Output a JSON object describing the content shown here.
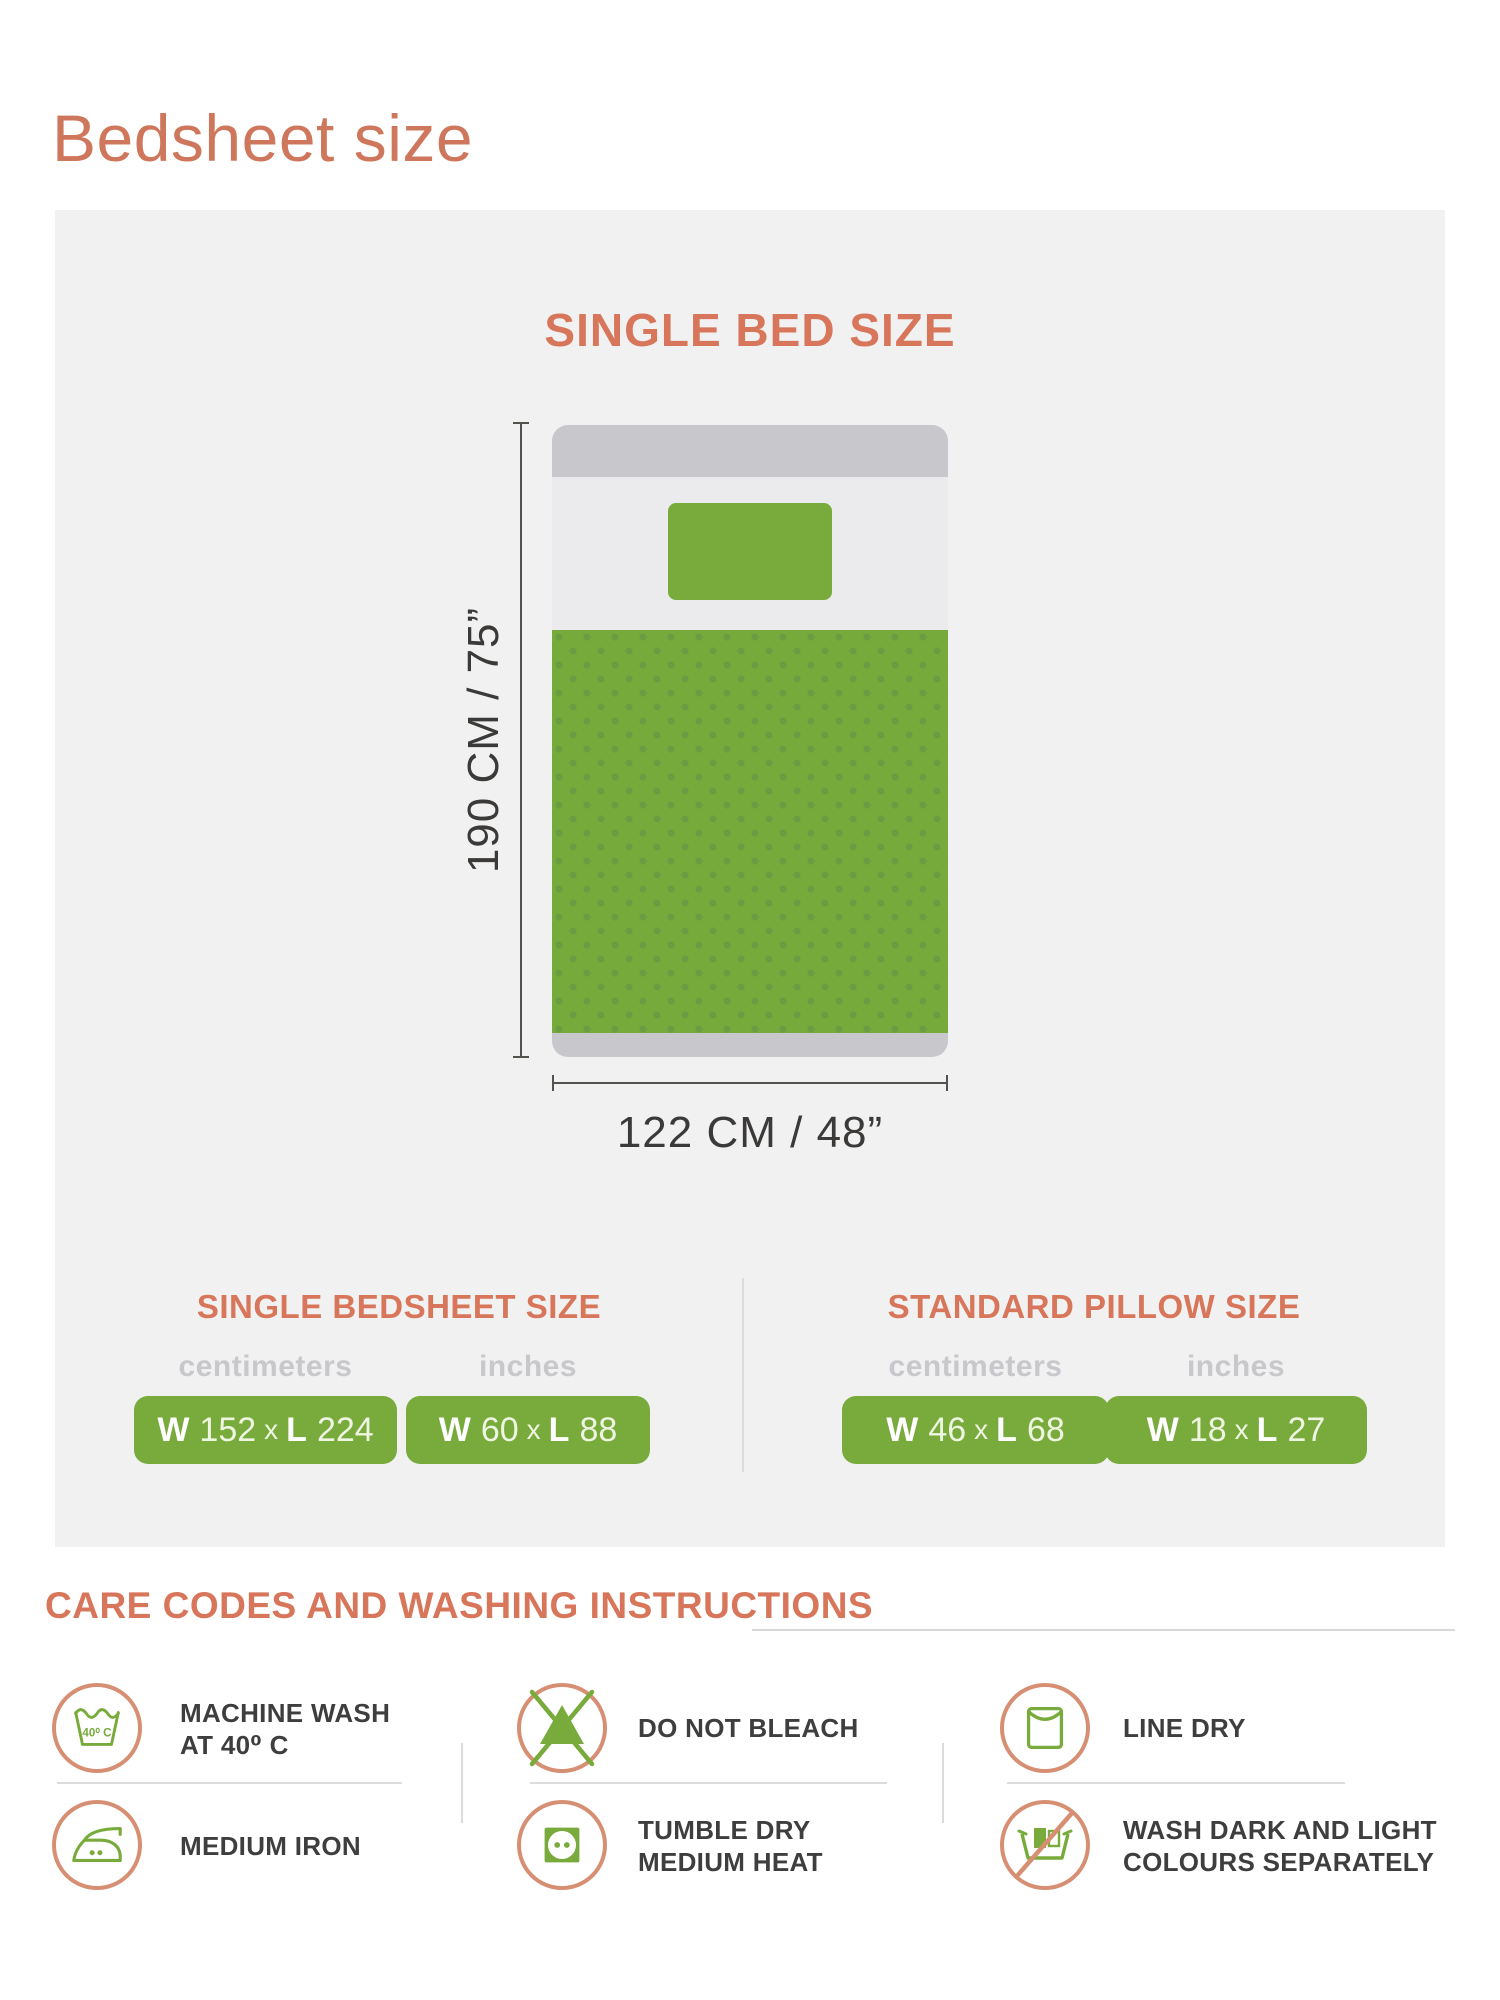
{
  "page_title": "Bedsheet size",
  "diagram": {
    "heading": "SINGLE BED SIZE",
    "height_label": "190 CM / 75”",
    "width_label": "122 CM / 48”"
  },
  "sections": {
    "bedsheet": {
      "heading": "SINGLE BEDSHEET SIZE",
      "units_cm": "centimeters",
      "units_in": "inches",
      "cm": {
        "w_key": "W",
        "w_val": "152",
        "sep": "x",
        "l_key": "L",
        "l_val": "224"
      },
      "inch": {
        "w_key": "W",
        "w_val": "60",
        "sep": "x",
        "l_key": "L",
        "l_val": "88"
      }
    },
    "pillow": {
      "heading": "STANDARD PILLOW SIZE",
      "units_cm": "centimeters",
      "units_in": "inches",
      "cm": {
        "w_key": "W",
        "w_val": "46",
        "sep": "x",
        "l_key": "L",
        "l_val": "68"
      },
      "inch": {
        "w_key": "W",
        "w_val": "18",
        "sep": "x",
        "l_key": "L",
        "l_val": "27"
      }
    }
  },
  "care": {
    "heading": "CARE CODES AND WASHING INSTRUCTIONS",
    "machine_wash": {
      "line1": "MACHINE WASH",
      "line2": "AT  40⁰ C",
      "tub_label": "40⁰ C"
    },
    "medium_iron": {
      "line1": "MEDIUM IRON"
    },
    "do_not_bleach": {
      "line1": "DO NOT BLEACH"
    },
    "tumble_dry": {
      "line1": "TUMBLE DRY",
      "line2": "MEDIUM HEAT"
    },
    "line_dry": {
      "line1": "LINE DRY"
    },
    "wash_separately": {
      "line1": "WASH DARK AND LIGHT",
      "line2": "COLOURS SEPARATELY"
    }
  },
  "colors": {
    "accent_salmon": "#d7765a",
    "green": "#78ab3c",
    "panel_gray": "#f1f1f1",
    "bar_gray": "#c8c7cc"
  }
}
